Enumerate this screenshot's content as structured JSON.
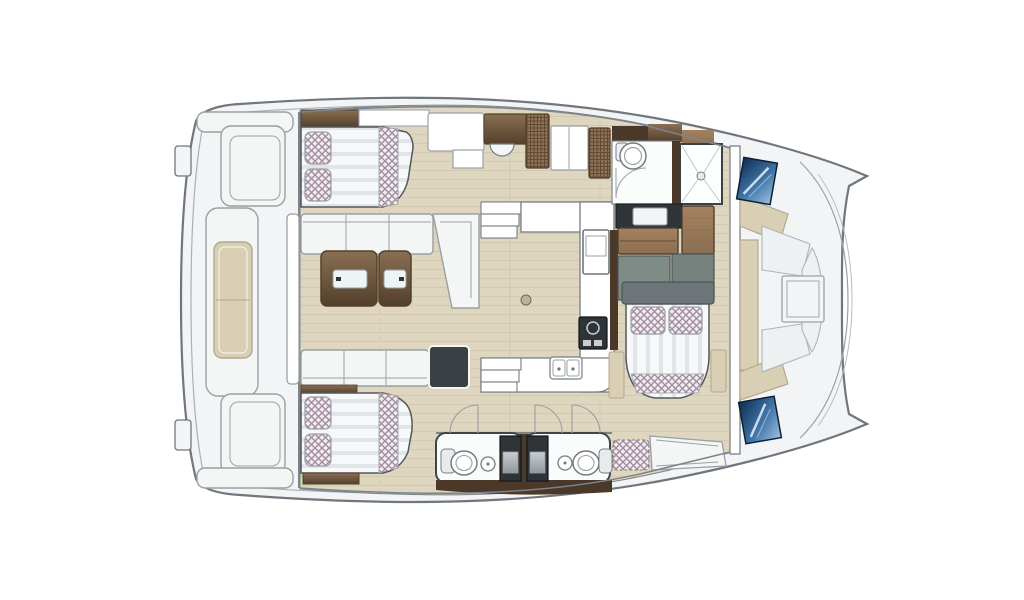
{
  "diagram": {
    "type": "catamaran-yacht-floor-plan",
    "view": "top-down interior deck plan, bow to the right, stern to the left",
    "rooms": [
      "aft-cockpit-with-bench-and-table",
      "salon-with-l-sofas-and-twin-tables",
      "port-double-cabin",
      "starboard-double-cabin",
      "owner-cabin-island-bed",
      "u-shaped-galley",
      "twin-heads-with-showers",
      "forward-head-with-shower",
      "foredeck-lounge-with-hatch"
    ],
    "fixtures": [
      "cockpit-table",
      "salon-tables",
      "sofas",
      "beds-with-checkered-pillows",
      "stove",
      "oven",
      "double-sink",
      "stairs",
      "toilets",
      "sinks",
      "showers",
      "wardrobes",
      "dressers",
      "hull-windows",
      "deck-hatch"
    ]
  },
  "colors": {
    "deck": "#f2f4f5",
    "deckShade": "#aab1b6",
    "hullStroke": "#6f767d",
    "wall": "#7c838a",
    "floor": "#ded6bf",
    "grainLine": "#d2c9ae",
    "white": "#ffffff",
    "cushion": "#f4f6f6",
    "cushionStroke": "#9aa0a4",
    "outlineDark": "#53585c",
    "mattress": "#f7f8f9",
    "stripe": "#e1e5e8",
    "checkerBg": "#f2edf0",
    "checkerLine": "#a28da0",
    "wickerBg": "#93745a",
    "wickerLine": "#5f4a33",
    "wood": "#8a6f52",
    "woodDark": "#53402c",
    "woodDeep": "#4a3828",
    "woodLight": "#a5825d",
    "charcoal": "#2e3437",
    "charcoalLight": "#3a4044",
    "sage": "#7e8b87",
    "sageDark": "#75827e",
    "beige": "#d8cfb4",
    "beigeStroke": "#b3a98e",
    "blueDark": "#0e2f52",
    "blueMid": "#3f74a8",
    "blueLight": "#9cc0dd",
    "silver1": "#c9ced2",
    "silver2": "#8f979c",
    "steel": "#767d82",
    "glass": "#eef3f4",
    "gray": "#6d7578",
    "grayStroke": "#4e5558"
  }
}
